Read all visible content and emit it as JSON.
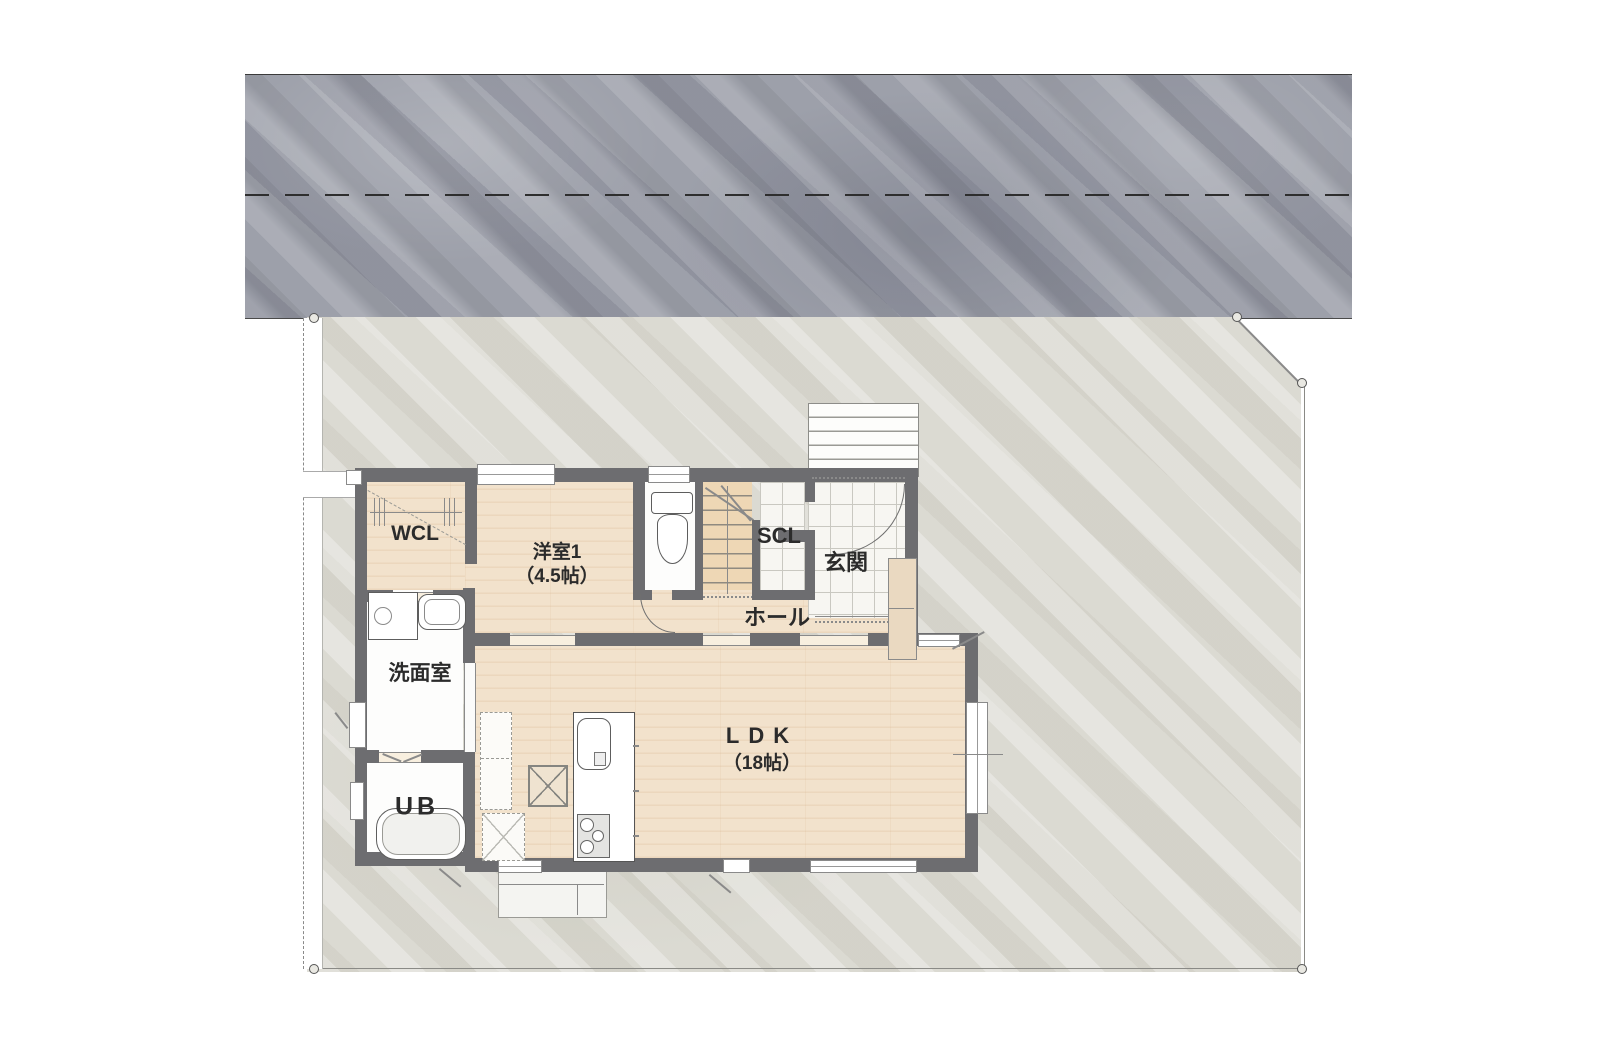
{
  "drawing": {
    "type": "residential-floor-plan",
    "rooms": {
      "wcl": {
        "label": "WCL"
      },
      "bedroom1": {
        "label": "洋室1",
        "size": "（4.5帖）"
      },
      "scl": {
        "label": "SCL"
      },
      "entrance": {
        "label": "玄関"
      },
      "hall": {
        "label": "ホール"
      },
      "washroom": {
        "label": "洗面室"
      },
      "bath": {
        "label": "UB"
      },
      "ldk": {
        "label": "LDK",
        "size": "（18帖）"
      }
    },
    "colors": {
      "road": "#9da0aa",
      "site": "#dbdad2",
      "wood_floor": "#f2e2cc",
      "wall": "#6d6d70",
      "tile": "#f7f6f2",
      "stairs": "#eed7b5",
      "cabinet": "#ead9c1"
    }
  }
}
